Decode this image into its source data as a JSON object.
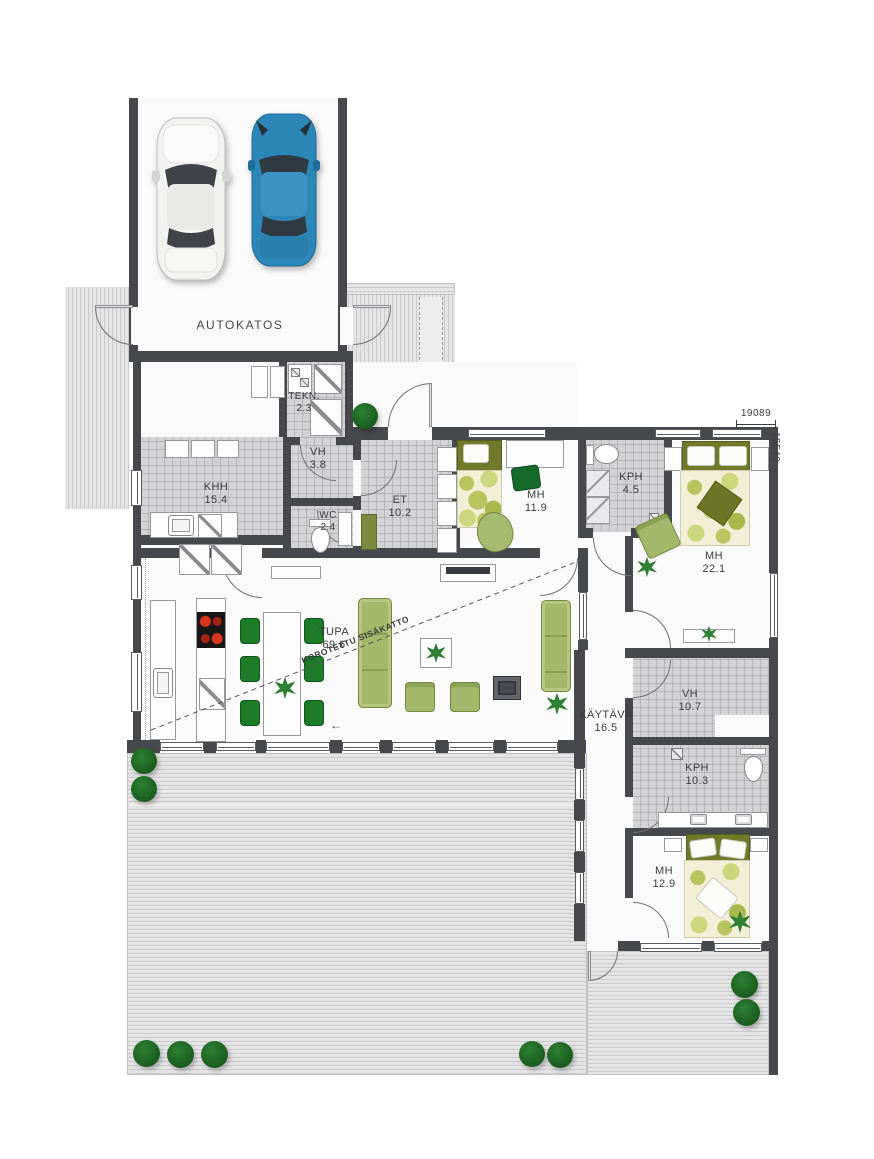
{
  "plan": {
    "rooms": [
      {
        "id": "autokatos",
        "label": "AUTOKATOS",
        "area": ""
      },
      {
        "id": "tekn",
        "label": "TEKN.",
        "area": "2.3"
      },
      {
        "id": "vh1",
        "label": "VH",
        "area": "3.8"
      },
      {
        "id": "khh",
        "label": "KHH",
        "area": "15.4"
      },
      {
        "id": "wc",
        "label": "WC",
        "area": "2.4"
      },
      {
        "id": "et",
        "label": "ET",
        "area": "10.2"
      },
      {
        "id": "mh1",
        "label": "MH",
        "area": "11.9"
      },
      {
        "id": "kph1",
        "label": "KPH",
        "area": "4.5"
      },
      {
        "id": "mh2",
        "label": "MH",
        "area": "22.1"
      },
      {
        "id": "tupa",
        "label": "TUPA",
        "area": "69.6"
      },
      {
        "id": "kaytava",
        "label": "KÄYTÄVÄ",
        "area": "16.5"
      },
      {
        "id": "vh2",
        "label": "VH",
        "area": "10.7"
      },
      {
        "id": "kph2",
        "label": "KPH",
        "area": "10.3"
      },
      {
        "id": "mh3",
        "label": "MH",
        "area": "12.9"
      }
    ],
    "annotations": {
      "raised_ceiling": "KOROTETTU SISÄKATTO",
      "slide_arrow": "←"
    },
    "dimensions": {
      "width_mm": "19089",
      "height_mm": "15540"
    },
    "icons": {
      "cars": [
        "white-car",
        "blue-car"
      ],
      "bush": "green-bush",
      "plant": "potted-plant"
    },
    "colors": {
      "wall": "#47484c",
      "tile_floor": "#d3d3d5",
      "deck": "#dcdcdd",
      "furniture_green": "#a3b86b",
      "accent_green": "#1c7c28",
      "car_blue": "#2c86b8",
      "duvet_base": "#f3efd7"
    }
  }
}
